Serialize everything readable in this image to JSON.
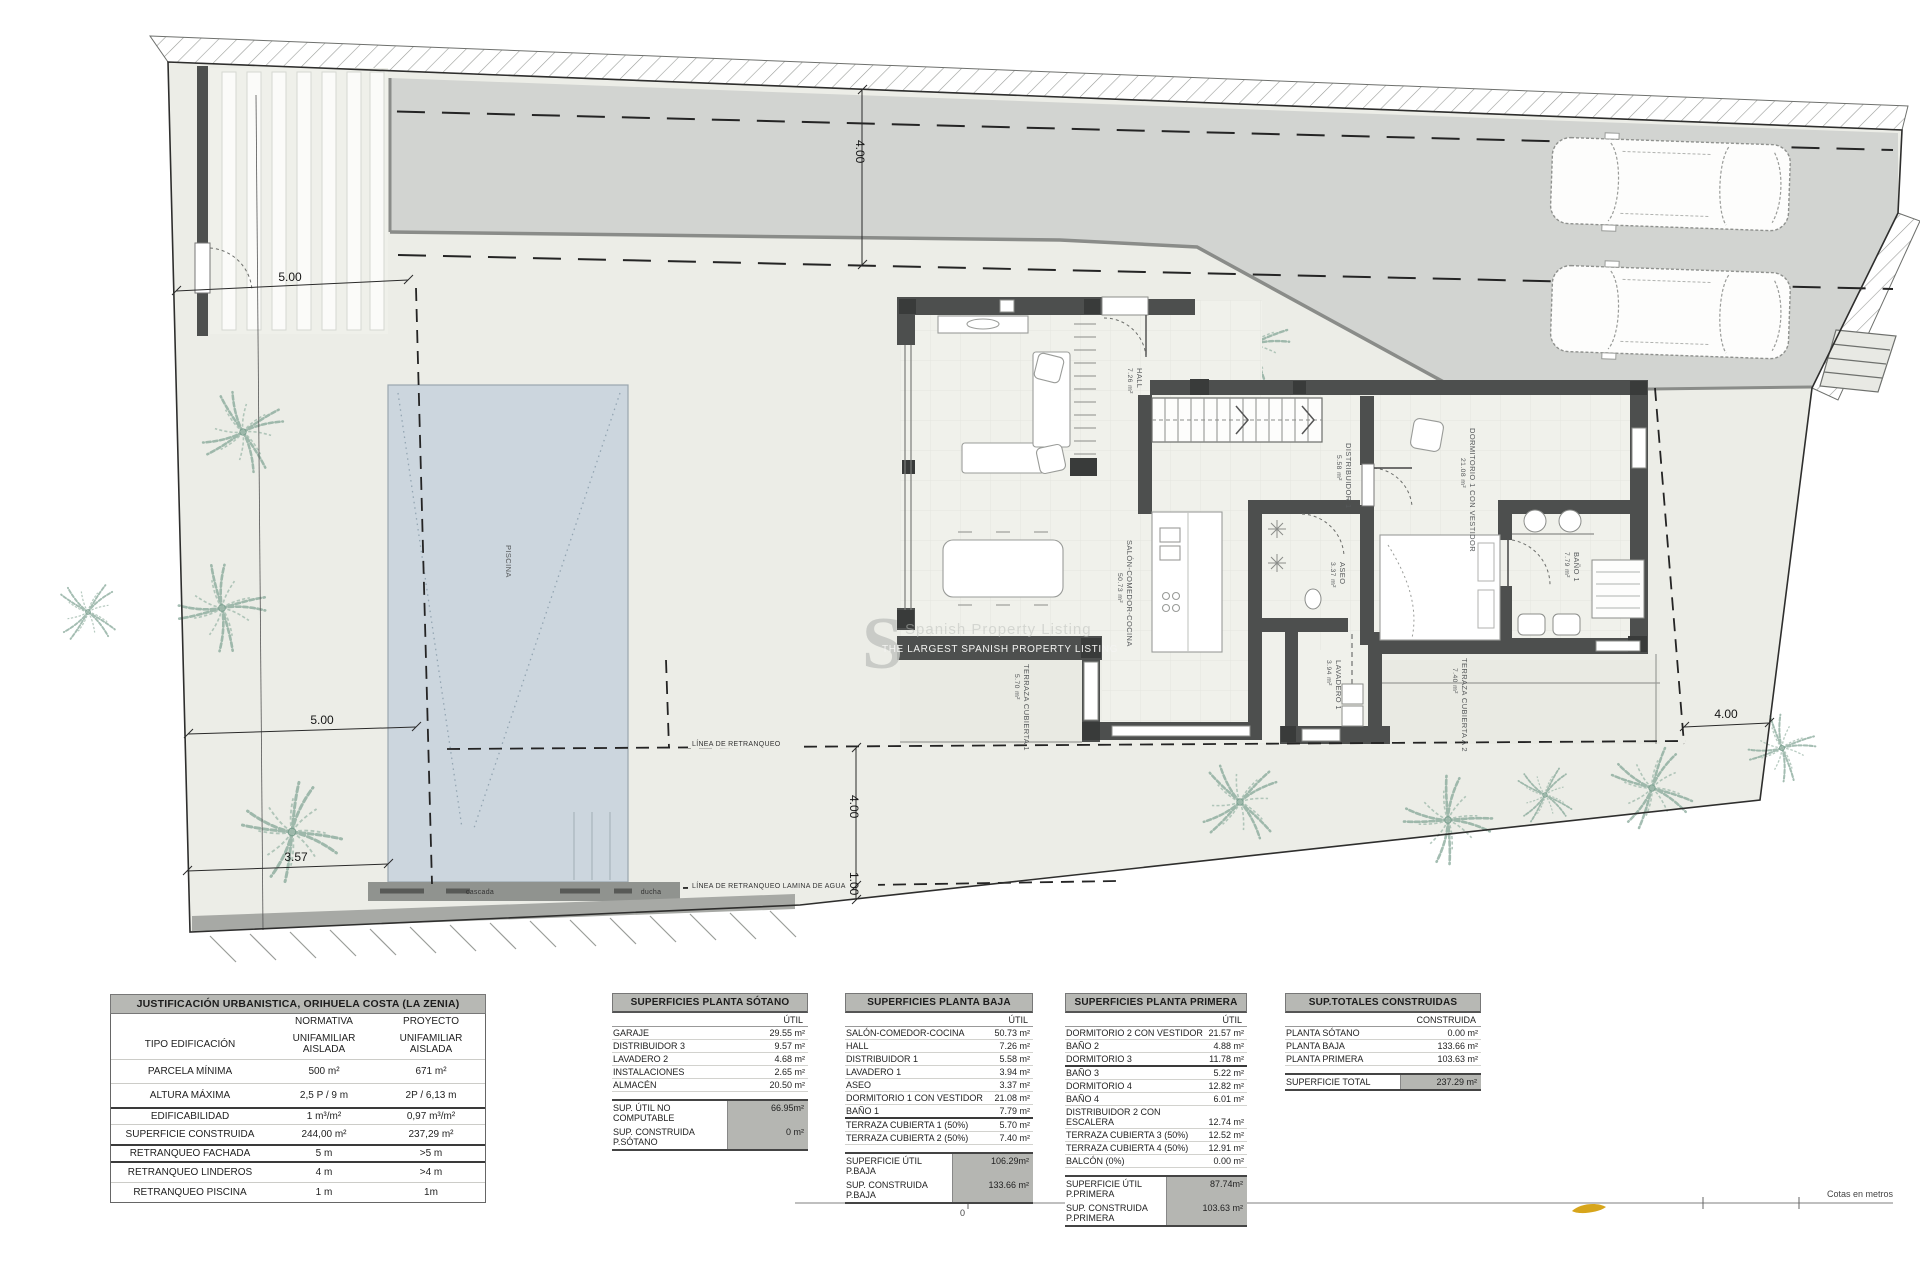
{
  "colors": {
    "wall": "#4d4f4e",
    "pool": "#ccd6de",
    "driveway": "#d2d4d1",
    "parcel": "#ecede7",
    "accent_swoosh": "#d7a51b"
  },
  "plan": {
    "watermark": {
      "letter": "S",
      "bar_text": "THE LARGEST SPANISH PROPERTY LISTING",
      "ghost_text": "Spanish Property Listing"
    },
    "rooms": [
      {
        "name": "HALL",
        "area": "7.26 m²"
      },
      {
        "name": "SALÓN-COMEDOR-COCINA",
        "area": "50.73 m²"
      },
      {
        "name": "DISTRIBUIDOR 1",
        "area": "5.58 m²"
      },
      {
        "name": "DORMITORIO 1 CON VESTIDOR",
        "area": "21.08 m²"
      },
      {
        "name": "BAÑO 1",
        "area": "7.79 m²"
      },
      {
        "name": "ASEO",
        "area": "3.37 m²"
      },
      {
        "name": "LAVADERO 1",
        "area": "3.94 m²"
      },
      {
        "name": "TERRAZA CUBIERTA 1",
        "area": "5.70 m²"
      },
      {
        "name": "TERRAZA CUBIERTA A 2",
        "area": "7.40 m²"
      },
      {
        "name": "PISCINA",
        "area": ""
      }
    ],
    "site_labels": {
      "cascada": "cascada",
      "ducha": "ducha",
      "setback": "LÍNEA DE RETRANQUEO",
      "setback_water": "LÍNEA DE RETRANQUEO LAMINA DE AGUA"
    },
    "dims": {
      "top5": "5.00",
      "top4": "4.00",
      "mid5": "5.00",
      "d357": "3.57",
      "bot4": "4.00",
      "bot1": "1.00",
      "right4": "4.00"
    },
    "scalebar": {
      "zero": "0",
      "text": "Cotas en metros"
    }
  },
  "tables": {
    "justificacion": {
      "title": "JUSTIFICACIÓN URBANISTICA, ORIHUELA COSTA (LA ZENIA)",
      "col_normativa": "NORMATIVA",
      "col_proyecto": "PROYECTO",
      "rows": [
        {
          "label": "TIPO EDIFICACIÓN",
          "normativa": "UNIFAMILIAR AISLADA",
          "proyecto": "UNIFAMILIAR AISLADA"
        },
        {
          "label": "PARCELA MÍNIMA",
          "normativa": "500 m²",
          "proyecto": "671 m²"
        },
        {
          "label": "ALTURA MÁXIMA",
          "normativa": "2,5 P / 9 m",
          "proyecto": "2P / 6,13 m"
        },
        {
          "label": "EDIFICABILIDAD",
          "normativa": "1 m³/m²",
          "proyecto": "0,97 m³/m²"
        },
        {
          "label": "SUPERFICIE CONSTRUIDA",
          "normativa": "244,00 m²",
          "proyecto": "237,29 m²"
        },
        {
          "label": "RETRANQUEO FACHADA",
          "normativa": "5 m",
          "proyecto": ">5 m"
        },
        {
          "label": "RETRANQUEO LINDEROS",
          "normativa": "4 m",
          "proyecto": ">4 m"
        },
        {
          "label": "RETRANQUEO PISCINA",
          "normativa": "1 m",
          "proyecto": "1m"
        }
      ]
    },
    "sotano": {
      "title": "SUPERFICIES PLANTA SÓTANO",
      "col": "ÚTIL",
      "rows": [
        [
          "GARAJE",
          "29.55 m²"
        ],
        [
          "DISTRIBUIDOR 3",
          "9.57 m²"
        ],
        [
          "LAVADERO 2",
          "4.68 m²"
        ],
        [
          "INSTALACIONES",
          "2.65 m²"
        ],
        [
          "ALMACÉN",
          "20.50 m²"
        ]
      ],
      "totals": [
        [
          "SUP. ÚTIL NO COMPUTABLE",
          "66.95m²"
        ],
        [
          "SUP. CONSTRUIDA P.SÓTANO",
          "0 m²"
        ]
      ]
    },
    "baja": {
      "title": "SUPERFICIES PLANTA BAJA",
      "col": "ÚTIL",
      "rows": [
        [
          "SALÓN-COMEDOR-COCINA",
          "50.73 m²"
        ],
        [
          "HALL",
          "7.26 m²"
        ],
        [
          "DISTRIBUIDOR 1",
          "5.58 m²"
        ],
        [
          "LAVADERO 1",
          "3.94 m²"
        ],
        [
          "ASEO",
          "3.37 m²"
        ],
        [
          "DORMITORIO 1 CON VESTIDOR",
          "21.08 m²"
        ],
        [
          "BAÑO 1",
          "7.79 m²"
        ],
        [
          "TERRAZA CUBIERTA 1 (50%)",
          "5.70 m²"
        ],
        [
          "TERRAZA CUBIERTA 2 (50%)",
          "7.40 m²"
        ]
      ],
      "totals": [
        [
          "SUPERFICIE ÚTIL P.BAJA",
          "106.29m²"
        ],
        [
          "SUP. CONSTRUIDA P.BAJA",
          "133.66 m²"
        ]
      ]
    },
    "primera": {
      "title": "SUPERFICIES PLANTA PRIMERA",
      "col": "ÚTIL",
      "rows": [
        [
          "DORMITORIO 2 CON VESTIDOR",
          "21.57 m²"
        ],
        [
          "BAÑO 2",
          "4.88 m²"
        ],
        [
          "DORMITORIO 3",
          "11.78 m²"
        ],
        [
          "BAÑO 3",
          "5.22 m²"
        ],
        [
          "DORMITORIO 4",
          "12.82 m²"
        ],
        [
          "BAÑO 4",
          "6.01 m²"
        ],
        [
          "DISTRIBUIDOR 2 CON ESCALERA",
          "12.74 m²"
        ],
        [
          "TERRAZA CUBIERTA 3 (50%)",
          "12.52 m²"
        ],
        [
          "TERRAZA CUBIERTA 4 (50%)",
          "12.91 m²"
        ],
        [
          "BALCÓN (0%)",
          "0.00 m²"
        ]
      ],
      "totals": [
        [
          "SUPERFICIE ÚTIL P.PRIMERA",
          "87.74m²"
        ],
        [
          "SUP. CONSTRUIDA P.PRIMERA",
          "103.63 m²"
        ]
      ]
    },
    "totales": {
      "title": "SUP.TOTALES CONSTRUIDAS",
      "col": "CONSTRUIDA",
      "rows": [
        [
          "PLANTA SÓTANO",
          "0.00 m²"
        ],
        [
          "PLANTA BAJA",
          "133.66 m²"
        ],
        [
          "PLANTA PRIMERA",
          "103.63 m²"
        ]
      ],
      "totals": [
        [
          "SUPERFICIE TOTAL",
          "237.29 m²"
        ]
      ]
    }
  }
}
